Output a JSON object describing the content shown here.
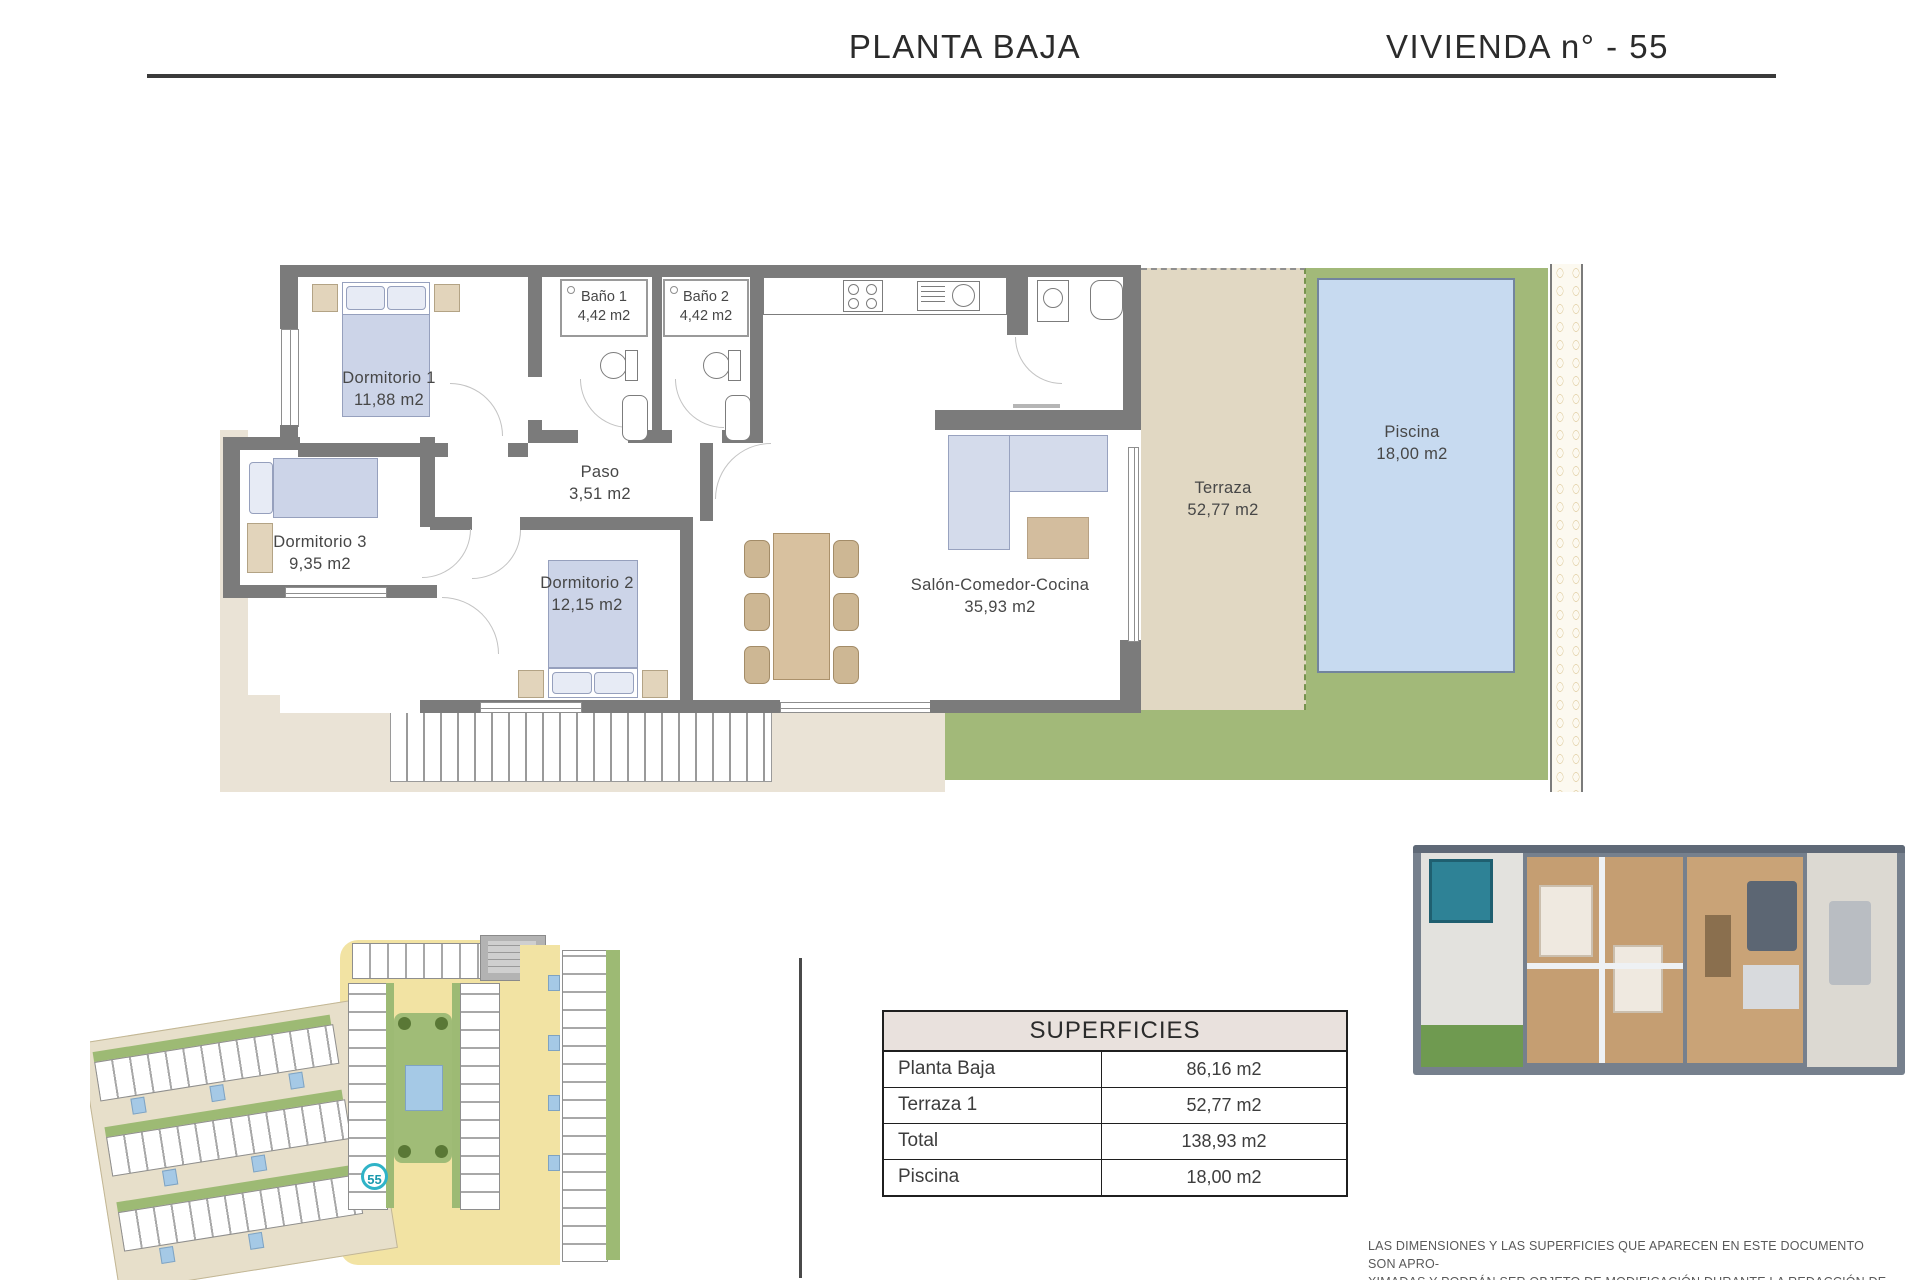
{
  "header": {
    "left_title": "PLANTA BAJA",
    "right_title": "VIVIENDA n° - 55"
  },
  "floor_plan": {
    "rooms": {
      "dormitorio1": {
        "name": "Dormitorio 1",
        "area": "11,88 m2"
      },
      "bano1": {
        "name": "Baño 1",
        "area": "4,42 m2"
      },
      "bano2": {
        "name": "Baño 2",
        "area": "4,42 m2"
      },
      "paso": {
        "name": "Paso",
        "area": "3,51 m2"
      },
      "dormitorio3": {
        "name": "Dormitorio 3",
        "area": "9,35 m2"
      },
      "dormitorio2": {
        "name": "Dormitorio 2",
        "area": "12,15 m2"
      },
      "salon": {
        "name": "Salón-Comedor-Cocina",
        "area": "35,93 m2"
      },
      "terraza": {
        "name": "Terraza",
        "area": "52,77 m2"
      },
      "piscina": {
        "name": "Piscina",
        "area": "18,00 m2"
      }
    }
  },
  "site_plan": {
    "unit_marker": "55"
  },
  "surfaces_table": {
    "title": "SUPERFICIES",
    "rows": [
      {
        "label": "Planta Baja",
        "value": "86,16 m2"
      },
      {
        "label": "Terraza 1",
        "value": "52,77 m2"
      },
      {
        "label": "Total",
        "value": "138,93 m2"
      },
      {
        "label": "Piscina",
        "value": "18,00 m2"
      }
    ]
  },
  "disclaimer": {
    "line1": "LAS DIMENSIONES Y LAS SUPERFICIES QUE APARECEN EN ESTE DOCUMENTO SON APRO-",
    "line2": "XIMADAS Y PODRÁN SER OBJETO DE MODIFICACIÓN DURANTE LA REDACCIÓN DE LOS",
    "line3": "PROYECTOS BÁSICO Y DE EJECUCIÓN."
  },
  "palette": {
    "wall_gray": "#7b7b7b",
    "terrace_beige": "#e1d8c3",
    "ground_beige": "#eae3d6",
    "grass_green": "#a2b979",
    "pool_blue": "#c7daf0",
    "furniture_blue": "#ccd4e8",
    "wood_tan": "#d8c19f",
    "marker_teal": "#2fb3c7",
    "table_header_bg": "#e9e1dd"
  }
}
